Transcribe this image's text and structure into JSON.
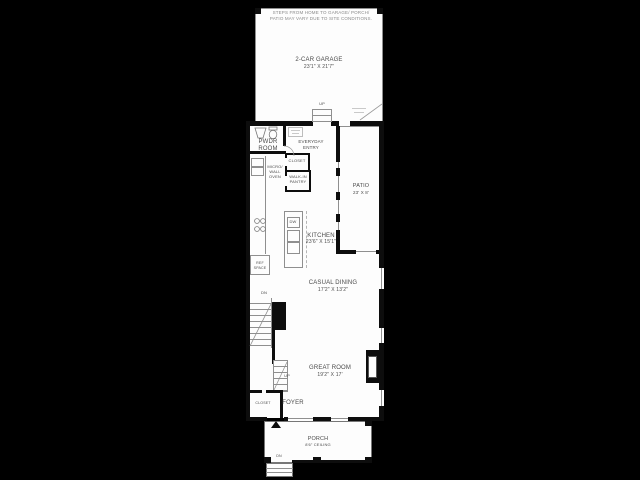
{
  "colors": {
    "background": "#000000",
    "paper": "#fdfdfd",
    "wall": "#0d0d0d",
    "line": "#8f8f8f",
    "text": "#4a4a4a"
  },
  "note": {
    "line1": "STEPS FROM HOME TO GARAGE/ PORCH/",
    "line2": "PATIO MAY VARY DUE TO SITE CONDITIONS."
  },
  "garage": {
    "title": "2-CAR GARAGE",
    "dims": "23'1\" X 21'7\"",
    "up": "UP"
  },
  "pwdr": {
    "line1": "PWDR",
    "line2": "ROOM"
  },
  "entry": {
    "line1": "EVERYDAY",
    "line2": "ENTRY"
  },
  "closet": {
    "name": "CLOSET"
  },
  "pantry": {
    "line1": "WALK-IN",
    "line2": "PANTRY"
  },
  "oven": {
    "line1": "MICRO/",
    "line2": "WALL",
    "line3": "OVEN"
  },
  "patio": {
    "title": "PATIO",
    "dims": "23' X 8'"
  },
  "kitchen": {
    "title": "KITCHEN",
    "dims": "23'6\" X 15'1\"",
    "dw": "DW"
  },
  "ref": {
    "line1": "REF",
    "line2": "SPACE"
  },
  "dining": {
    "title": "CASUAL DINING",
    "dims": "17'2\" X 13'2\""
  },
  "stairs": {
    "dn": "DN",
    "up": "UP"
  },
  "great": {
    "title": "GREAT ROOM",
    "dims": "19'2\" X 17'"
  },
  "foyer": {
    "title": "FOYER",
    "closet": "CLOSET"
  },
  "porch": {
    "title": "PORCH",
    "dims": "8'6\" CEILING",
    "dn": "DN"
  }
}
